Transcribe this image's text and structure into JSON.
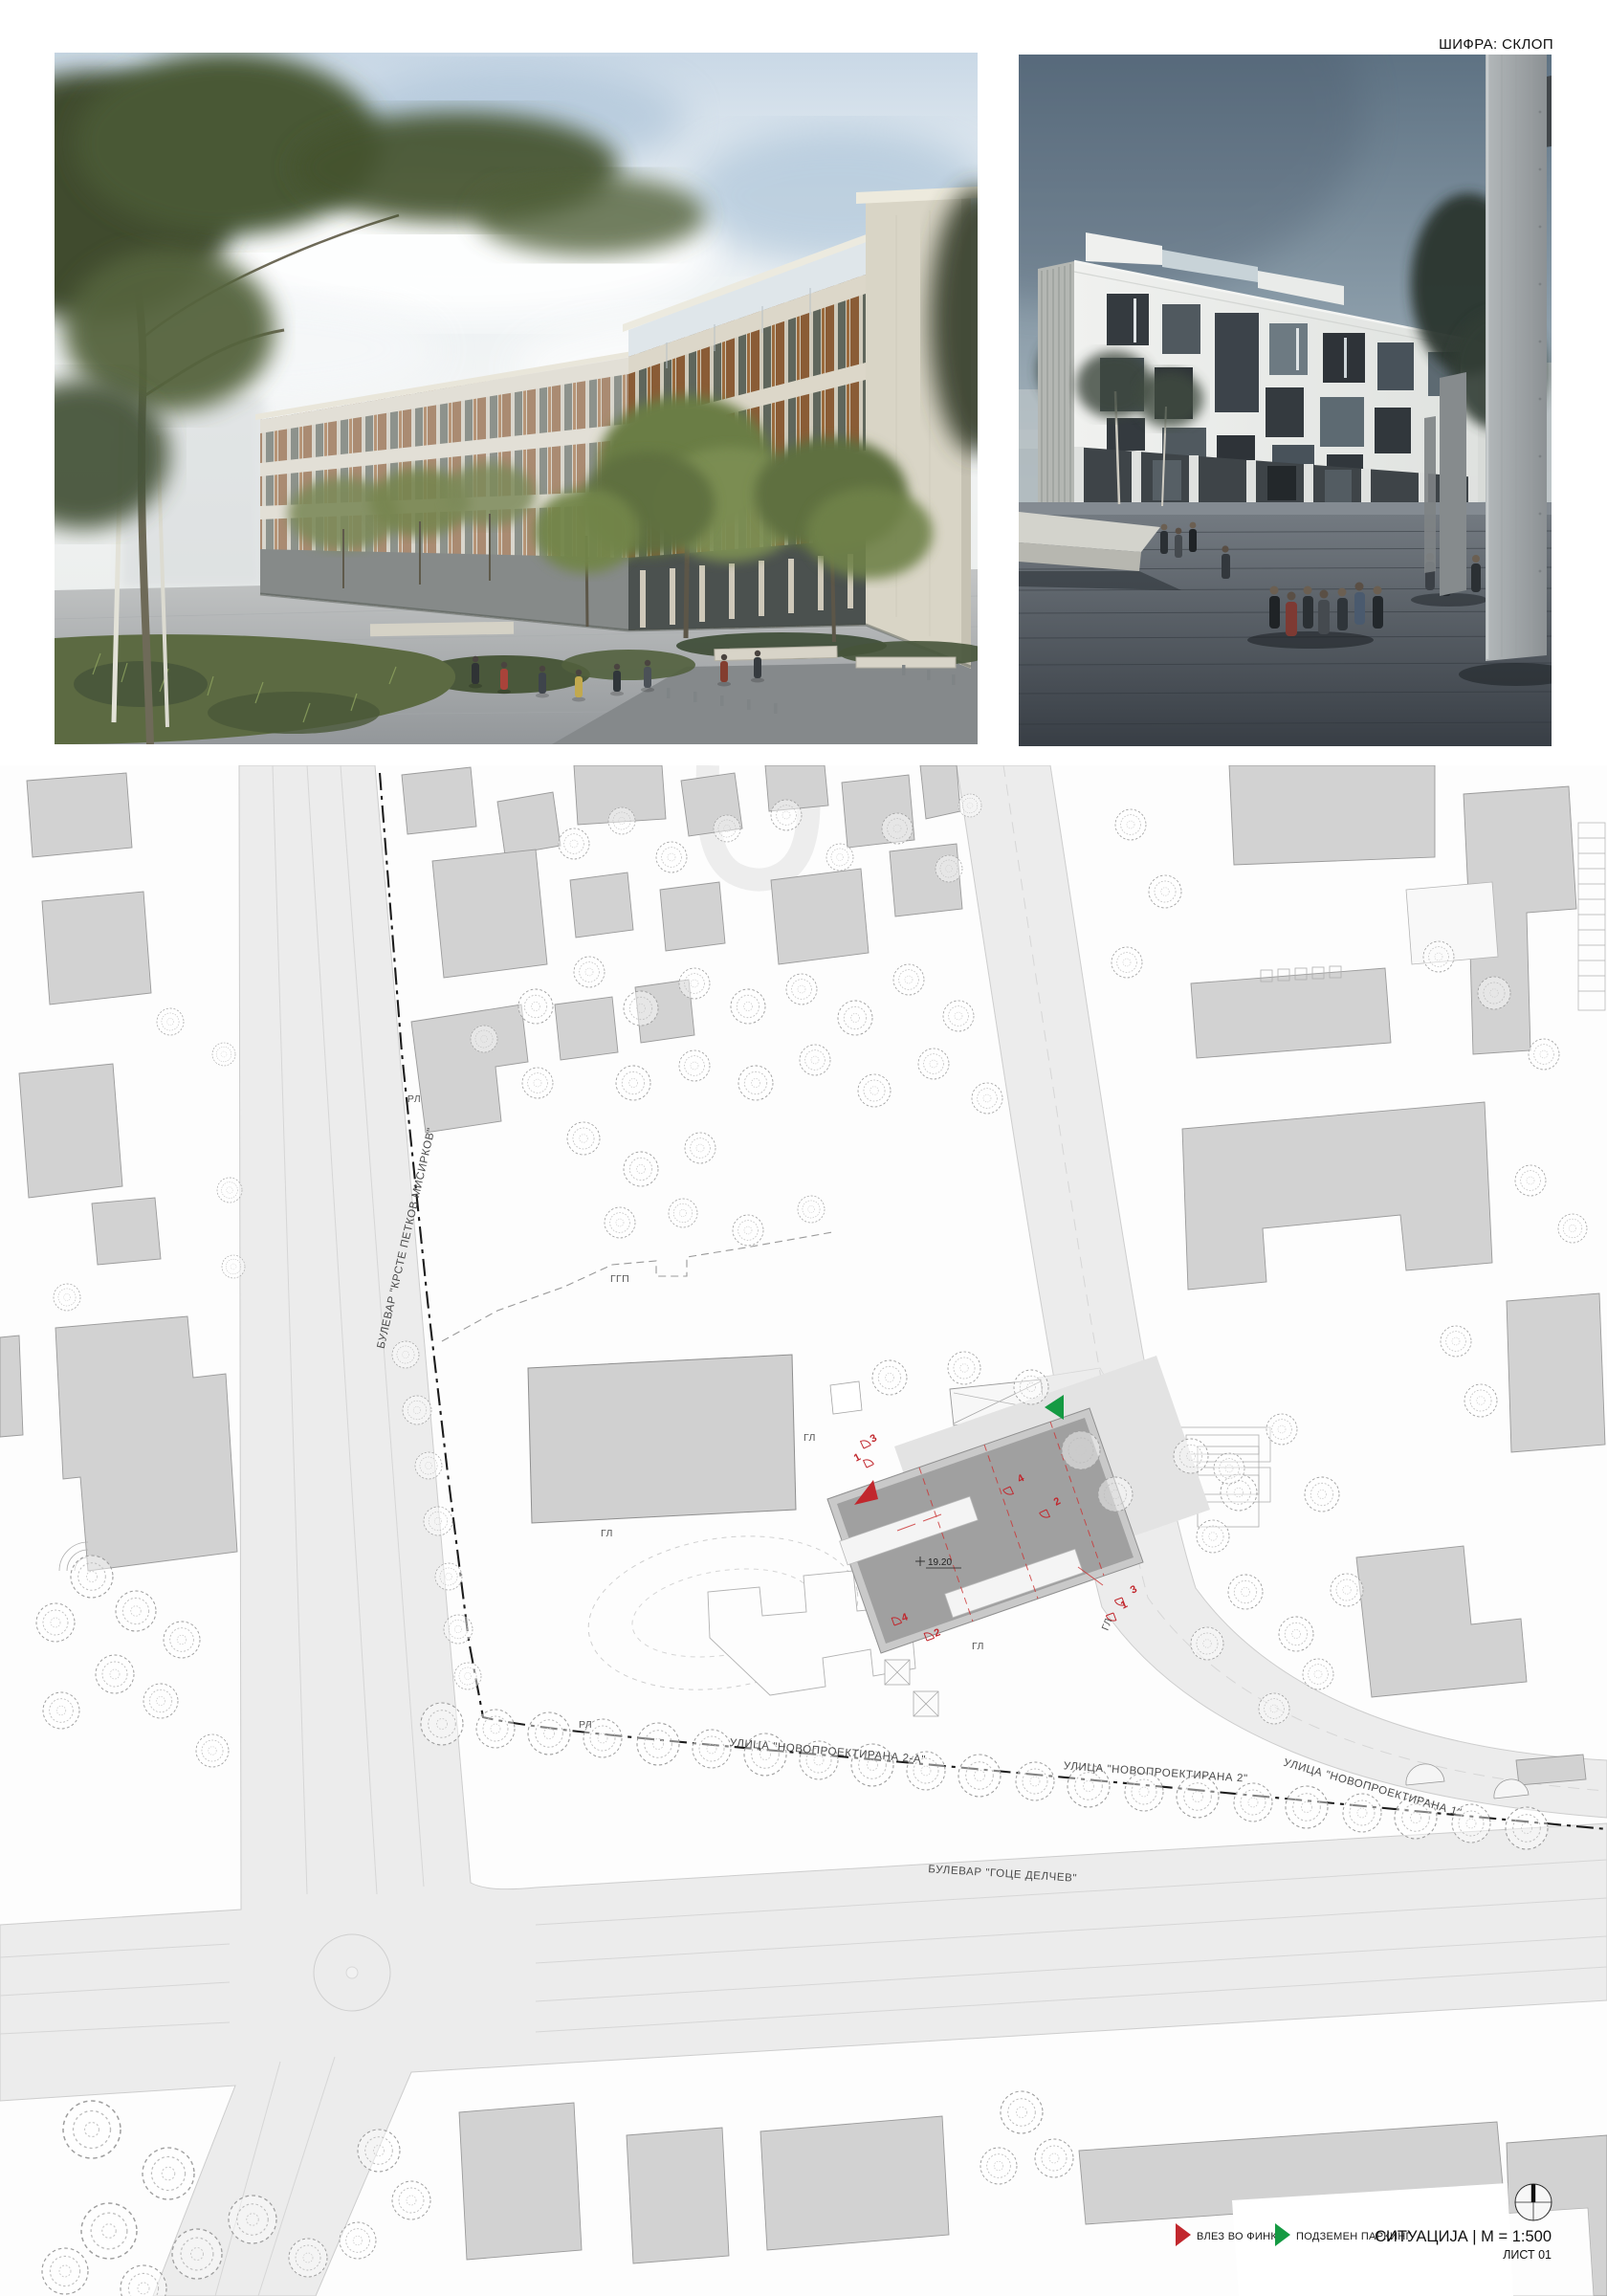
{
  "sheet": {
    "code_label": "ШИФРА: СКЛОП"
  },
  "plan": {
    "streets": {
      "boulevard_left": "БУЛЕВАР \"КРСТЕ ПЕТКОВ МИСИРКОВ\"",
      "boulevard_bottom": "БУЛЕВАР \"ГОЦЕ ДЕЛЧЕВ\"",
      "street_new_2a": "УЛИЦА \"НОВОПРОЕКТИРАНА 2-А\"",
      "street_new_2": "УЛИЦА \"НОВОПРОЕКТИРАНА 2\"",
      "street_new_1": "УЛИЦА \"НОВОПРОЕКТИРАНА 1\""
    },
    "regulation": {
      "rl": "РЛ",
      "ggp": "ГГП",
      "gl": "ГЛ"
    },
    "building": {
      "height_label": "19.20"
    },
    "entries": {
      "n1": "1",
      "n2": "2",
      "n3": "3",
      "n4": "4"
    },
    "colors": {
      "entrance_red": "#c1272d",
      "parking_green": "#159a43"
    }
  },
  "legend": {
    "entrance_label": "ВЛЕЗ ВО ФИНКИ",
    "parking_label": "ПОДЗЕМЕН ПАРКИНГ",
    "scale_title": "СИТУАЦИЈА | М = 1:500",
    "sheet_number": "ЛИСТ 01"
  }
}
